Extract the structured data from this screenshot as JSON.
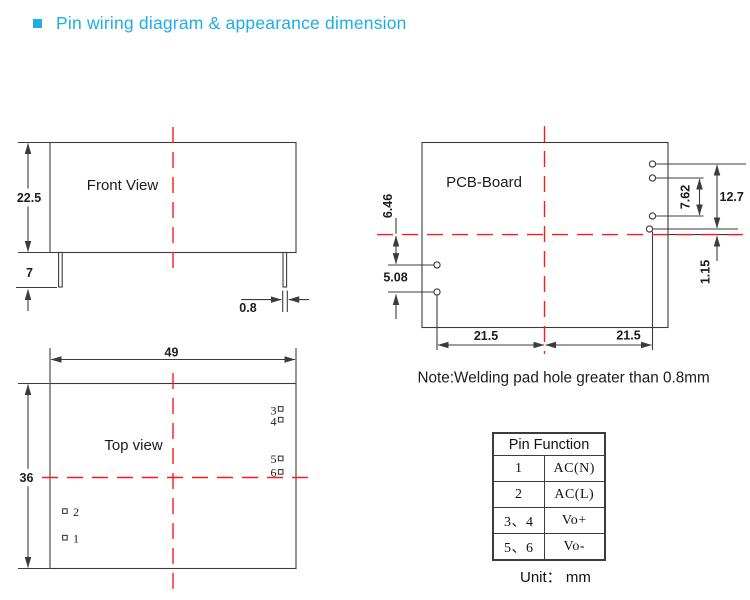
{
  "title": "Pin wiring diagram & appearance dimension",
  "colors": {
    "accent": "#1fade6",
    "centerline_red": "#ff1a1a",
    "drawing_line": "#3c3c3c"
  },
  "front_view": {
    "label": "Front View",
    "dims": {
      "body_height": "22.5",
      "pin_length": "7",
      "pin_width": "0.8"
    }
  },
  "pcb_view": {
    "label": "PCB-Board",
    "dims": {
      "left_upper": "6.46",
      "left_lower": "5.08",
      "right_inner": "7.62",
      "right_outer": "12.7",
      "right_offset": "1.15",
      "bottom_left": "21.5",
      "bottom_right": "21.5"
    },
    "note": "Note:Welding pad hole greater than 0.8mm"
  },
  "top_view": {
    "label": "Top view",
    "dims": {
      "width": "49",
      "height": "36"
    },
    "pins": [
      "1",
      "2",
      "3",
      "4",
      "5",
      "6"
    ]
  },
  "pin_table": {
    "header": "Pin Function",
    "rows": [
      {
        "pin": "1",
        "function": "AC(N)"
      },
      {
        "pin": "2",
        "function": "AC(L)"
      },
      {
        "pin": "3、4",
        "function": "Vo+"
      },
      {
        "pin": "5、6",
        "function": "Vo-"
      }
    ],
    "unit": "Unit： mm"
  }
}
